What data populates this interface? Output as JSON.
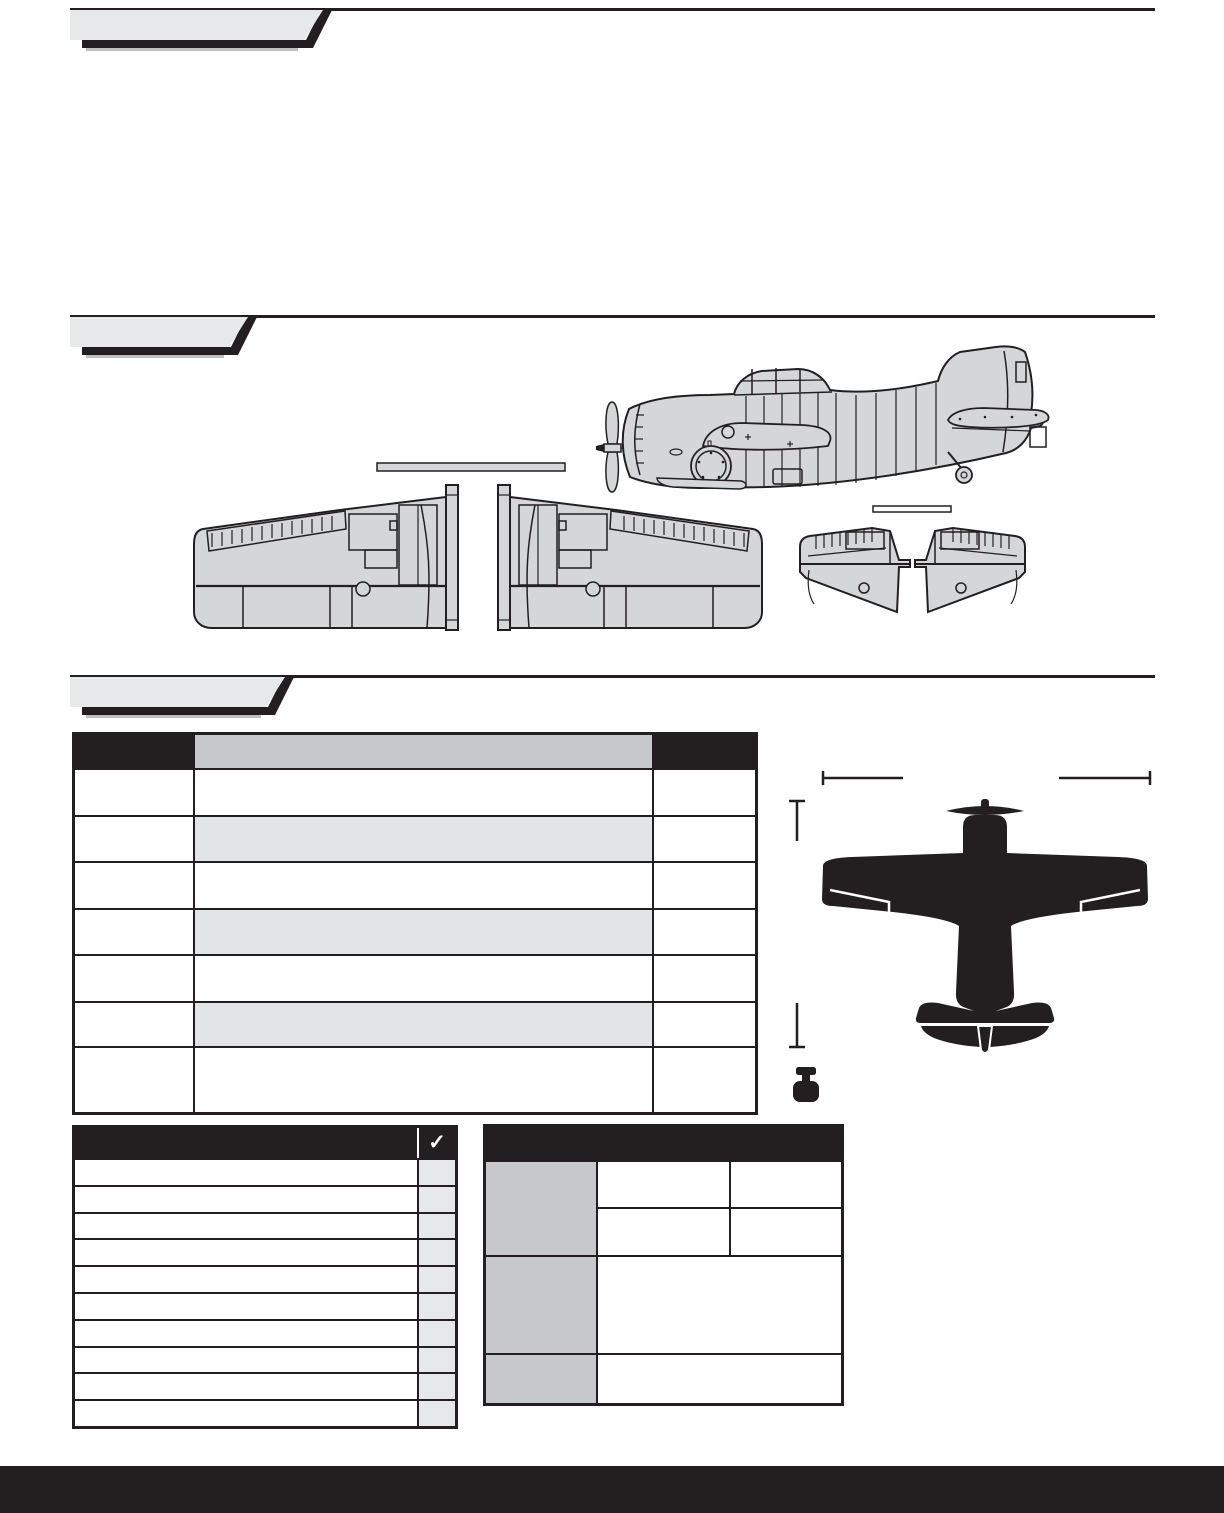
{
  "colors": {
    "ink": "#231f20",
    "banner_gray": "#e7e8e9",
    "panel_fill": "#d5d6d7",
    "table_header_gray": "#c6c8ca",
    "row_shade_gray": "#e3e4e5",
    "checkbox_gray": "#e7e8e9",
    "white": "#ffffff"
  },
  "banners": [
    {
      "label": ""
    },
    {
      "label": ""
    },
    {
      "label": ""
    }
  ],
  "spec_table": {
    "header": {
      "col1": "",
      "col2": "",
      "col3": ""
    },
    "rows": [
      "",
      "",
      "",
      "",
      "",
      "",
      ""
    ]
  },
  "checklist": {
    "header_label": "",
    "check_icon": "✓",
    "rows": [
      "",
      "",
      "",
      "",
      "",
      "",
      "",
      "",
      "",
      ""
    ]
  },
  "info_table": {
    "header_label": "",
    "group1": {
      "label": "",
      "sub_rows": [
        [
          "",
          ""
        ],
        [
          "",
          ""
        ]
      ]
    },
    "group2": {
      "label": "",
      "value": ""
    },
    "group3": {
      "label": "",
      "value": ""
    }
  },
  "footer": {
    "label": ""
  }
}
